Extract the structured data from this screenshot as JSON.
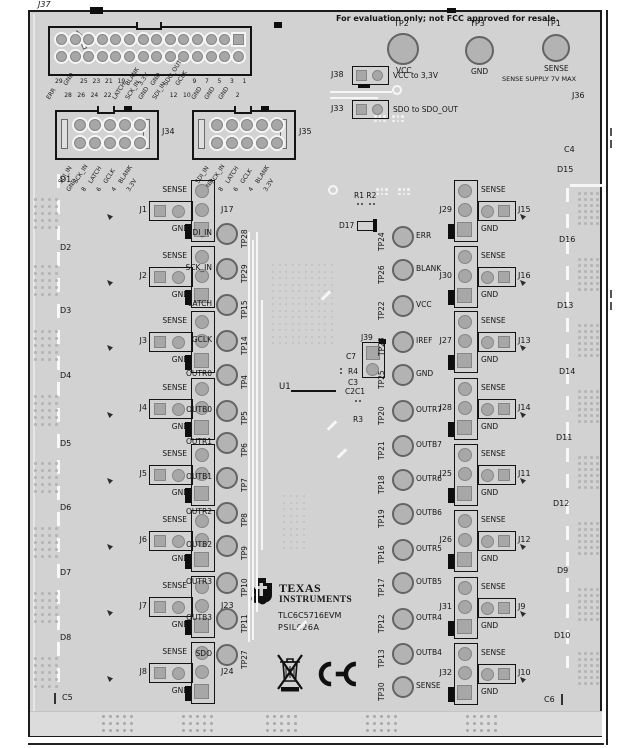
{
  "note": "For evaluation only; not FCC approved for resale.",
  "labels": {
    "sense": "SENSE",
    "gnd": "GND"
  },
  "top": {
    "j37": "J37",
    "j37_row1": [
      "29",
      "GND",
      "25",
      "23",
      "21",
      "19",
      "BLANK",
      "3.3V",
      "GND",
      "SDO_OUT",
      "GCLK",
      "9",
      "7",
      "5",
      "3",
      "1"
    ],
    "j37_row2": [
      "ERR",
      "28",
      "26",
      "24",
      "22",
      "LATCH",
      "SCK_IN",
      "GND",
      "SDI_IN",
      "12",
      "10",
      "GND",
      "GND",
      "GND",
      "2"
    ],
    "tp2": {
      "name": "TP2",
      "signal": "VCC"
    },
    "tp3": {
      "name": "TP3",
      "signal": "GND"
    },
    "tp1": {
      "name": "TP1",
      "signal": "SENSE",
      "note": "SENSE SUPPLY 7V MAX"
    },
    "j38": {
      "name": "J38",
      "desc": "VCC to 3,3V"
    },
    "j33": {
      "name": "J33",
      "desc": "SDO to SDO_OUT"
    },
    "j36": "J36",
    "j34": "J34",
    "j35": "J35",
    "header_pins_upper": [
      "SDI_IN",
      "SCK_IN",
      "LATCH",
      "GCLK",
      "BLANK"
    ],
    "header_pins_lower": [
      "GND",
      "8",
      "6",
      "4",
      "3.3V"
    ]
  },
  "edges": {
    "left": [
      "D1",
      "D2",
      "D3",
      "D4",
      "D5",
      "D6",
      "D7",
      "D8"
    ],
    "c5": "C5",
    "right": [
      "C4",
      "D15",
      "D16",
      "D13",
      "D14",
      "D11",
      "D12",
      "D9",
      "D10"
    ],
    "c6": "C6"
  },
  "left_jumpers": [
    {
      "j": "J1",
      "h": "J17"
    },
    {
      "j": "J2",
      "h": "J18"
    },
    {
      "j": "J3",
      "h": "J19"
    },
    {
      "j": "J4",
      "h": "J20"
    },
    {
      "j": "J5",
      "h": "J21"
    },
    {
      "j": "J6",
      "h": "J22"
    },
    {
      "j": "J7",
      "h": "J23"
    },
    {
      "j": "J8",
      "h": "J24"
    }
  ],
  "right_jumpers": [
    {
      "j": "J29",
      "h": "J15"
    },
    {
      "j": "J30",
      "h": "J16"
    },
    {
      "j": "J27",
      "h": "J13"
    },
    {
      "j": "J28",
      "h": "J14"
    },
    {
      "j": "J25",
      "h": "J11"
    },
    {
      "j": "J26",
      "h": "J12"
    },
    {
      "j": "J31",
      "h": "J9"
    },
    {
      "j": "J32",
      "h": "J10"
    }
  ],
  "left_tps": [
    {
      "signal": "SDI_IN",
      "tp": "TP28"
    },
    {
      "signal": "SCK_IN",
      "tp": "TP29"
    },
    {
      "signal": "LATCH",
      "tp": "TP15"
    },
    {
      "signal": "GCLK",
      "tp": "TP14"
    },
    {
      "signal": "OUTR0",
      "tp": "TP4"
    },
    {
      "signal": "OUTB0",
      "tp": "TP5"
    },
    {
      "signal": "OUTR1",
      "tp": "TP6"
    },
    {
      "signal": "OUTB1",
      "tp": "TP7"
    },
    {
      "signal": "OUTR2",
      "tp": "TP8"
    },
    {
      "signal": "OUTB2",
      "tp": "TP9"
    },
    {
      "signal": "OUTR3",
      "tp": "TP10"
    },
    {
      "signal": "OUTB3",
      "tp": "TP11"
    },
    {
      "signal": "SDO",
      "tp": "TP27"
    }
  ],
  "right_tps": [
    {
      "tp": "TP24",
      "signal": "ERR"
    },
    {
      "tp": "TP26",
      "signal": "BLANK"
    },
    {
      "tp": "TP22",
      "signal": "VCC"
    },
    {
      "tp": "TP23",
      "signal": "IREF"
    },
    {
      "tp": "TP25",
      "signal": "GND"
    },
    {
      "tp": "TP20",
      "signal": "OUTR7"
    },
    {
      "tp": "TP21",
      "signal": "OUTB7"
    },
    {
      "tp": "TP18",
      "signal": "OUTR6"
    },
    {
      "tp": "TP19",
      "signal": "OUTB6"
    },
    {
      "tp": "TP16",
      "signal": "OUTR5"
    },
    {
      "tp": "TP17",
      "signal": "OUTB5"
    },
    {
      "tp": "TP12",
      "signal": "OUTR4"
    },
    {
      "tp": "TP13",
      "signal": "OUTB4"
    },
    {
      "tp": "TP30",
      "signal": "SENSE"
    }
  ],
  "center": {
    "r1r2": "R1 R2",
    "d17": "D17",
    "j39": "J39",
    "c7": "C7",
    "r4": "R4",
    "c3": "C3",
    "c2c1": "C2C1",
    "r3": "R3",
    "u1": "U1"
  },
  "branding": {
    "line1": "TEXAS",
    "line2": "INSTRUMENTS",
    "part": "TLC6C5716EVM",
    "code": "PSIL026A"
  },
  "colors": {
    "board": "#d2d2d2",
    "pad": "#a7a7a7",
    "ink": "#151515",
    "silk": "#f6f6f6"
  }
}
